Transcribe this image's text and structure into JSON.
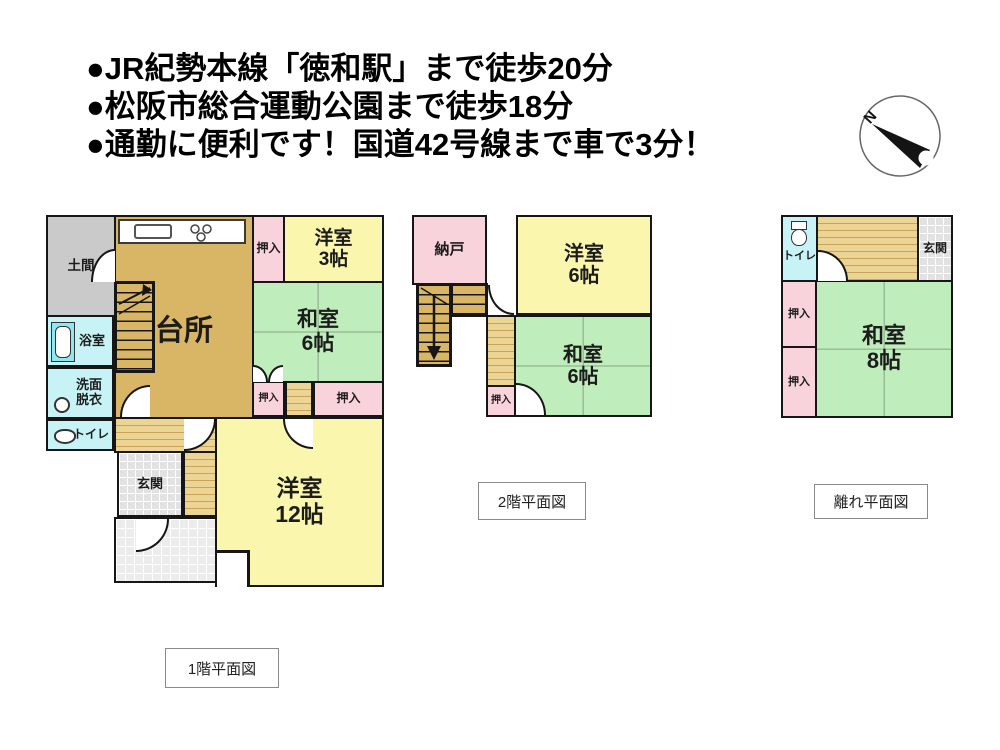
{
  "header": {
    "lines": [
      "●JR紀勢本線「徳和駅」まで徒歩20分",
      "●松阪市総合運動公園まで徒歩18分",
      "●通勤に便利です！国道42号線まで車で3分！"
    ]
  },
  "compass": {
    "north_label": "N"
  },
  "plans": [
    {
      "caption": "1階平面図",
      "rooms": {
        "doma": "土間",
        "kitchen": "台所",
        "oshiire_top": "押入",
        "yoshitsu3": {
          "name": "洋室",
          "size": "3帖"
        },
        "washitsu6": {
          "name": "和室",
          "size": "6帖"
        },
        "bath": "浴室",
        "senmen": {
          "line1": "洗面",
          "line2": "脱衣"
        },
        "toilet": "トイレ",
        "oshiire_left": "押入",
        "oshiire_right": "押入",
        "genkan": "玄関",
        "yoshitsu12": {
          "name": "洋室",
          "size": "12帖"
        }
      }
    },
    {
      "caption": "2階平面図",
      "rooms": {
        "nando": "納戸",
        "yoshitsu6": {
          "name": "洋室",
          "size": "6帖"
        },
        "washitsu6": {
          "name": "和室",
          "size": "6帖"
        },
        "oshiire": "押入"
      }
    },
    {
      "caption": "離れ平面図",
      "rooms": {
        "toilet": "トイレ",
        "genkan": "玄関",
        "oshiire_top": "押入",
        "oshiire_bottom": "押入",
        "washitsu8": {
          "name": "和室",
          "size": "8帖"
        }
      }
    }
  ],
  "colors": {
    "wall": "#161616",
    "kitchen_tan": "#D9B566",
    "hall_tan_light": "#EBD494",
    "hall_tan_stripe": "#C8A45A",
    "room_yellow": "#FBF6AD",
    "room_green": "#C0EDBC",
    "closet_pink": "#F8D3DB",
    "wet_area_cyan": "#C7F3F6",
    "bathtub_cyan": "#8FE8F0",
    "doma_gray": "#CACACA",
    "entrance_gray": "#E2E2E2"
  }
}
